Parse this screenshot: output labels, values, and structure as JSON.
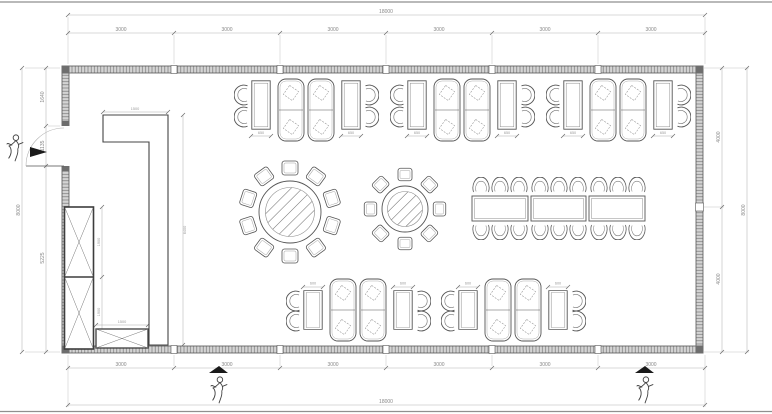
{
  "dimensions": {
    "top": {
      "total": "18000",
      "segments": [
        "3000",
        "3000",
        "3000",
        "3000",
        "3000",
        "3000"
      ]
    },
    "bottom": {
      "total": "18000",
      "segments": [
        "3000",
        "3000",
        "3000",
        "3000",
        "3000",
        "3000"
      ]
    },
    "left": {
      "total": "8000",
      "segments": [
        "1640",
        "1135",
        "5225"
      ]
    },
    "right": {
      "total": "8000",
      "segments": [
        "4000",
        "4000"
      ]
    }
  },
  "interior": {
    "partition": {
      "width": "1500",
      "length": "6400"
    },
    "cabinet": {
      "upper": "1900",
      "lower": "1900",
      "base_width": "1500"
    },
    "booths_top": {
      "table_width": "650",
      "table_length": "1200"
    },
    "booths_bottom": {
      "table_width": "600",
      "table_length": "1100"
    }
  },
  "colors": {
    "line": "#555555",
    "wall_fill": "#d4d4d4",
    "dim_line": "#b5b5b5",
    "dim_text": "#878787",
    "accent": "#1a1a1a"
  }
}
